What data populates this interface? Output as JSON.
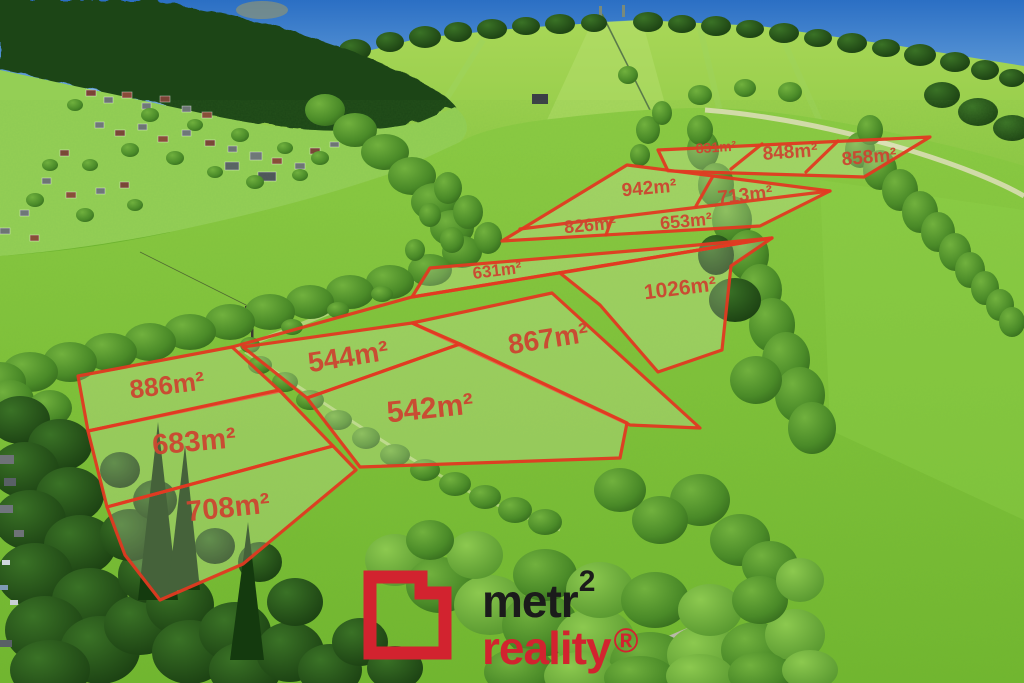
{
  "parcels": [
    {
      "id": "831",
      "area": "831m²"
    },
    {
      "id": "848",
      "area": "848m²"
    },
    {
      "id": "858",
      "area": "858m²"
    },
    {
      "id": "942",
      "area": "942m²"
    },
    {
      "id": "713",
      "area": "713m²"
    },
    {
      "id": "826",
      "area": "826m²"
    },
    {
      "id": "653",
      "area": "653m²"
    },
    {
      "id": "631",
      "area": "631m²"
    },
    {
      "id": "1026",
      "area": "1026m²"
    },
    {
      "id": "867",
      "area": "867m²"
    },
    {
      "id": "544",
      "area": "544m²"
    },
    {
      "id": "542",
      "area": "542m²"
    },
    {
      "id": "886",
      "area": "886m²"
    },
    {
      "id": "683",
      "area": "683m²"
    },
    {
      "id": "708",
      "area": "708m²"
    }
  ],
  "logo": {
    "name": "metr",
    "name_sup": "2",
    "tagline": "reality",
    "tagline_sup": "®"
  },
  "colors": {
    "parcel_outline": "#e23a22",
    "parcel_label": "#cc4631",
    "logo_red": "#d2232f",
    "logo_black": "#1b1b1b",
    "sky": "#3f80cf",
    "meadow": "#7fc63b",
    "forest": "#1d4a18"
  }
}
